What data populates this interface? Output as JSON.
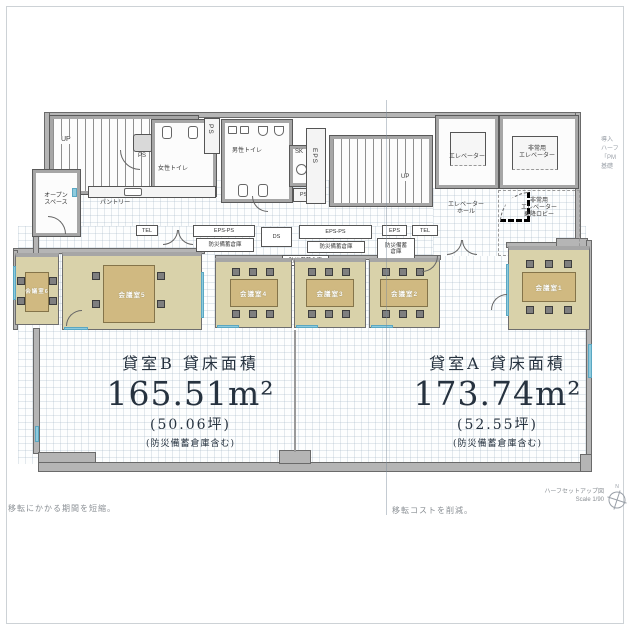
{
  "tenants": {
    "b": {
      "title": "貸室B 貸床面積",
      "area": "165.51m²",
      "tsubo": "(50.06坪)",
      "note": "(防災備蓄倉庫含む)"
    },
    "a": {
      "title": "貸室A 貸床面積",
      "area": "173.74m²",
      "tsubo": "(52.55坪)",
      "note": "(防災備蓄倉庫含む)"
    }
  },
  "core": {
    "up1": "UP",
    "up2": "UP",
    "ps1": "PS",
    "ps2": "PS",
    "ps3": "PS",
    "womens_toilet": "女性トイレ",
    "mens_toilet": "男性トイレ",
    "sk": "SK",
    "eps_shaft": "EPS",
    "open_space_line1": "オープン",
    "open_space_line2": "スペース",
    "pantry": "パントリー",
    "elevator": "エレベーター",
    "emergency_line1": "非常用",
    "emergency_line2": "エレベーター",
    "hall_line1": "エレベーター",
    "hall_line2": "ホール",
    "lobby_line1": "非常用",
    "lobby_line2": "エレベーター",
    "lobby_line3": "乗降ロビー"
  },
  "services": {
    "tel1": "TEL",
    "tel2": "TEL",
    "epsps1": "EPS-PS",
    "epsps2": "EPS-PS",
    "ds": "DS",
    "eps2": "EPS",
    "storage": "防災備蓄倉庫",
    "storage_line1": "防災備蓄",
    "storage_line2": "倉庫"
  },
  "meeting_rooms": [
    {
      "label": "会議室6"
    },
    {
      "label": "会議室5"
    },
    {
      "label": "会議室4"
    },
    {
      "label": "会議室3"
    },
    {
      "label": "会議室2"
    },
    {
      "label": "会議室1"
    }
  ],
  "footer": {
    "left_note": "移転にかかる期間を短縮。",
    "right_note": "移転コストを削減。",
    "drawing_title": "ハーフセットアップ図",
    "scale": "Scale 1/90",
    "north_label": "N"
  },
  "side_note": {
    "line1": "導入",
    "line2": "ハーフ",
    "line3": "「PM",
    "line4": "基礎"
  },
  "colors": {
    "wall": "#b5b5b5",
    "wall_edge": "#4f4f4f",
    "room_fill": "#d9d2aa",
    "table": "#d0b981",
    "chair": "#7f7f7f",
    "window": "#8ecbde",
    "ink": "#26323f"
  }
}
